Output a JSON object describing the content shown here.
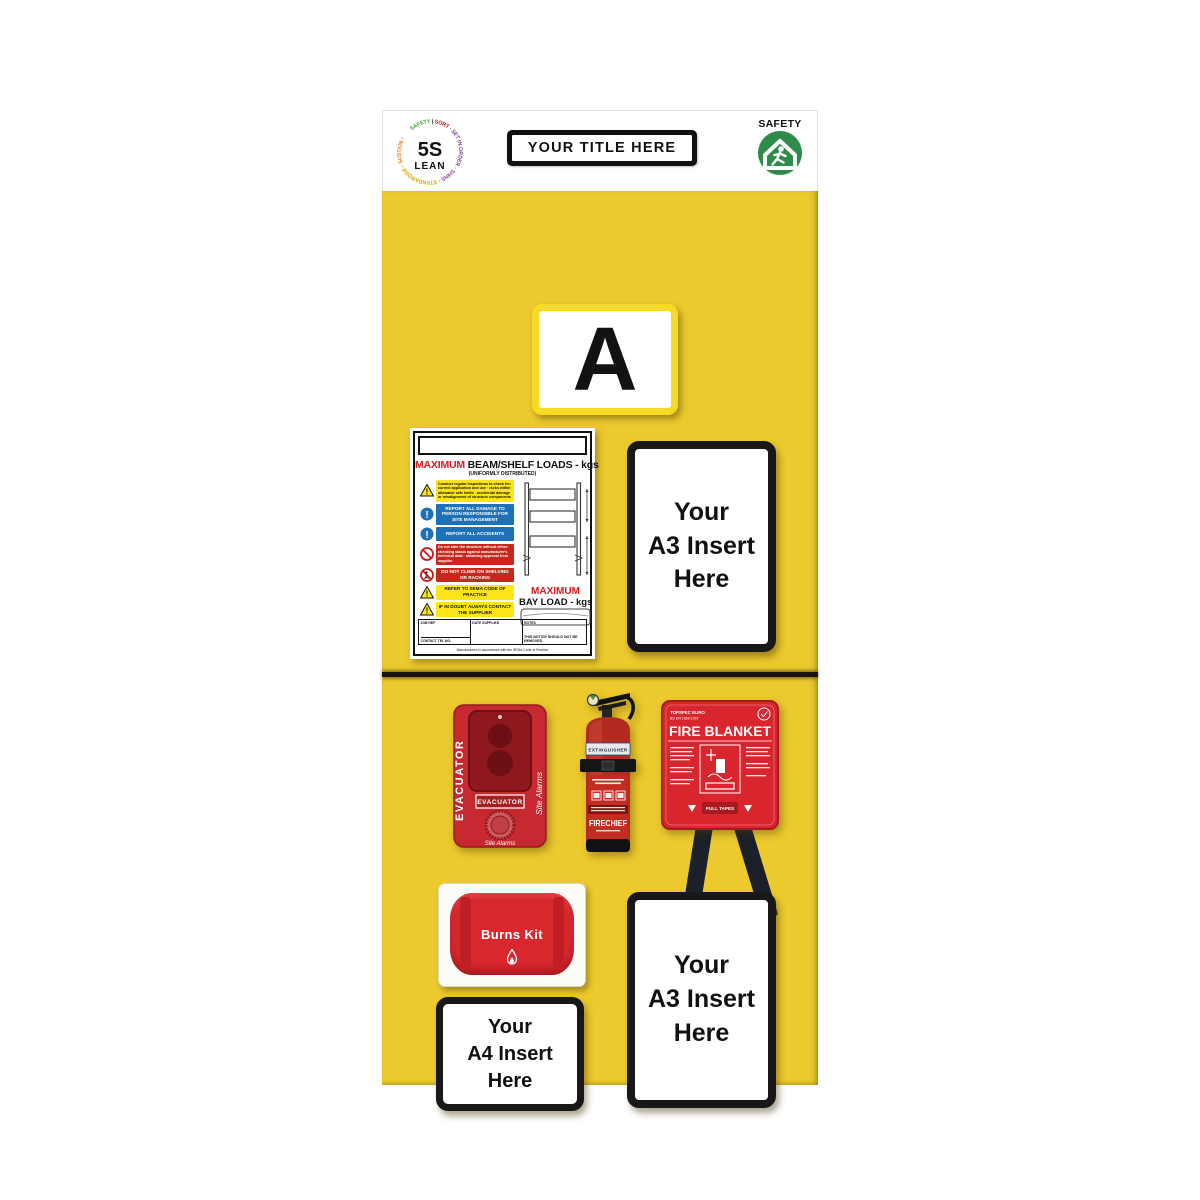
{
  "colors": {
    "board_yellow": "#ecc92d",
    "bright_yellow_frame": "#f7da25",
    "frame_black": "#181818",
    "accent_red": "#d71920",
    "mandatory_blue": "#1d71b8",
    "sign_yellow": "#ffe41c",
    "safety_green": "#2e8b4a",
    "equipment_red": "#c62a30"
  },
  "header": {
    "logo": {
      "center_line1": "5S",
      "center_line2": "LEAN",
      "ring": [
        {
          "text": "SAFETY ",
          "color": "#3aa335"
        },
        {
          "text": "| ",
          "color": "#1a1a1a"
        },
        {
          "text": "SORT ",
          "color": "#e30613"
        },
        {
          "text": "· ",
          "color": "#1a1a1a"
        },
        {
          "text": "SET IN ORDER ",
          "color": "#7b3f9a"
        },
        {
          "text": "· ",
          "color": "#1a1a1a"
        },
        {
          "text": "SHINE ",
          "color": "#9a4f9e"
        },
        {
          "text": "· ",
          "color": "#1a1a1a"
        },
        {
          "text": "STANDARDISE ",
          "color": "#d9a300"
        },
        {
          "text": "· ",
          "color": "#1a1a1a"
        },
        {
          "text": "SUSTAIN ",
          "color": "#ef7d1a"
        },
        {
          "text": "·",
          "color": "#1a1a1a"
        }
      ]
    },
    "title_box": "YOUR TITLE HERE",
    "safety_badge_label": "SAFETY"
  },
  "bay_letter": "A",
  "load_notice": {
    "title_red": "MAXIMUM",
    "title_rest": " BEAM/SHELF LOADS - kgs",
    "subtitle": "(UNIFORMLY DISTRIBUTED)",
    "rows": [
      {
        "type": "warning",
        "text": "Conduct regular inspections to check for: correct application and use · racks within allowable safe limits · accidental damage or misalignment of structure components"
      },
      {
        "type": "mandatory",
        "text": "REPORT ALL DAMAGE TO PERSON RESPONSIBLE FOR SITE MANAGEMENT"
      },
      {
        "type": "mandatory",
        "text": "REPORT ALL ACCIDENTS"
      },
      {
        "type": "prohibition",
        "text": "Do not alter the structure without either: checking status against manufacturer's technical data · obtaining approval from supplier"
      },
      {
        "type": "prohibition-climb",
        "text": "DO NOT CLIMB ON SHELVING OR RACKING"
      },
      {
        "type": "warning",
        "text": "REFER TO SEMA CODE OF PRACTICE"
      },
      {
        "type": "warning",
        "text": "IF IN DOUBT ALWAYS CONTACT THE SUPPLIER"
      }
    ],
    "bay_title_red": "MAXIMUM",
    "bay_title_rest": "BAY LOAD - kgs",
    "footer": {
      "job_ref": "JOB REF",
      "contact": "CONTACT TEL NO.",
      "date_supplied": "DATE SUPPLIED",
      "notes": "NOTES",
      "notice": "THIS NOTICE SHOULD NOT BE REMOVED",
      "small_print": "Manufactured in accordance with the SEMA Code of Practice"
    }
  },
  "inserts": {
    "a3_top": "Your\nA3 Insert\nHere",
    "a4": "Your\nA4 Insert\nHere",
    "a3_bottom": "Your\nA3 Insert\nHere"
  },
  "equipment": {
    "evacuator": {
      "side_label": "EVACUATOR",
      "brand_script": "Site Alarms",
      "panel_label": "EVACUATOR",
      "bottom_script": "Site Alarms"
    },
    "extinguisher": {
      "band_label": "EXTINGUISHER",
      "brand": "FIRECHIEF"
    },
    "fire_blanket": {
      "spec_line1": "TOPSPEC EURO",
      "spec_line2": "BS EN 1869:1997",
      "title": "FIRE BLANKET",
      "pull_label": "PULL TAPES"
    },
    "burns_kit": {
      "label": "Burns Kit"
    }
  }
}
